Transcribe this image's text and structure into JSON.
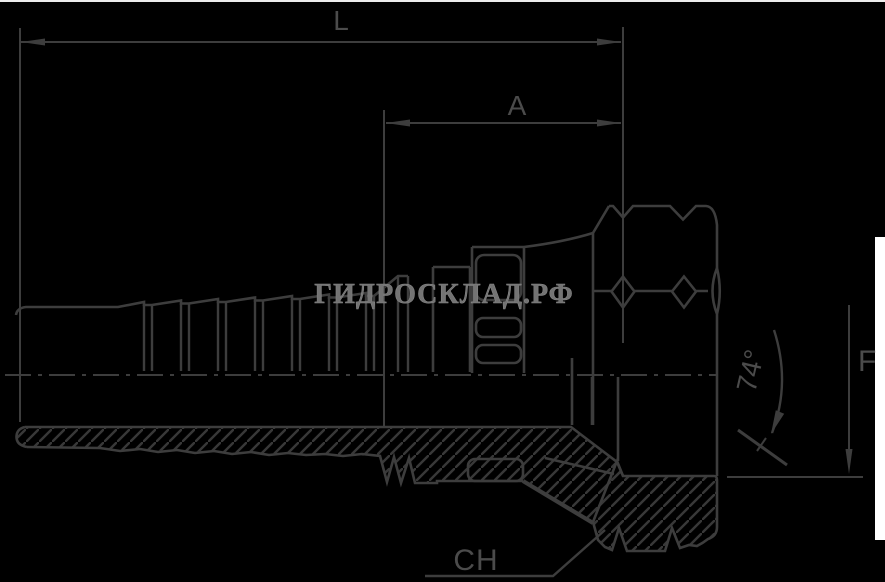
{
  "drawing": {
    "type": "technical-drawing",
    "background_color": "#000000",
    "line_color": "#3d3d3d",
    "label_color": "#4b4b4b",
    "watermark_color": "#737373",
    "edge_strip_color": "#ffffff"
  },
  "labels": {
    "length_dim": "L",
    "crimp_dim": "A",
    "flare_dim": "F",
    "cone_angle": "74°",
    "hex_size": "CH"
  },
  "watermark": {
    "text": "ГИДРОСКЛАД.РФ"
  }
}
